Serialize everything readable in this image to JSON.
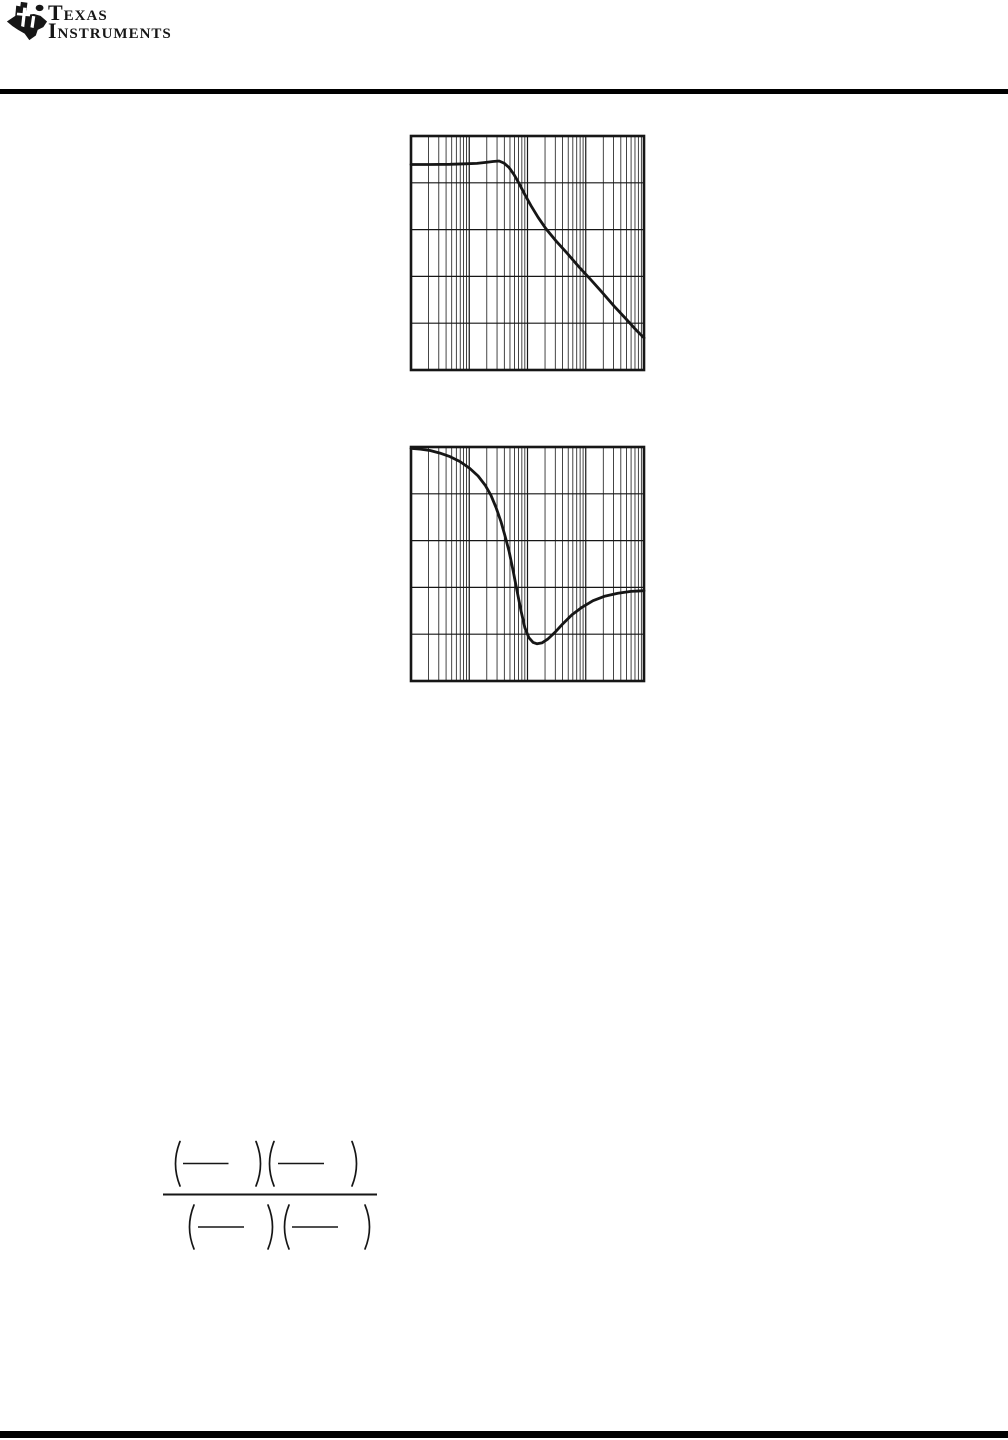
{
  "page": {
    "background": "#ffffff",
    "ink_color": "#161616",
    "note": "Datasheet page render in which all body text glyphs failed to render; only vector graphics (logo, chart grids, curves, formula fence/bars, rules) are visible."
  },
  "header": {
    "logo": {
      "icon": "ti-texas-bug-icon",
      "brand_line1": "Texas",
      "brand_line2": "Instruments"
    },
    "rule_color": "#000000"
  },
  "chart_data": [
    {
      "id": "magnitude-response",
      "type": "line",
      "title": "",
      "xlabel": "",
      "ylabel": "",
      "axis_tick_labels_rendered": false,
      "x_scale": "log",
      "x_decades": 4,
      "x_minor_divisions": [
        2,
        3,
        4,
        5,
        6,
        7,
        8,
        9
      ],
      "y_divisions": 5,
      "grid": true,
      "line_color": "#161616",
      "frame_px": {
        "left": 411,
        "top": 136,
        "width": 233,
        "height": 234
      },
      "description": "Gain-style curve: flat at ~0.12 of plot height for first ~1.5 decades, tiny peak near 0.38 of width, then steady log-linear roll-off exiting right edge at ~0.86 of height.",
      "points_frac": [
        [
          0.0,
          0.122
        ],
        [
          0.082,
          0.122
        ],
        [
          0.167,
          0.121
        ],
        [
          0.232,
          0.119
        ],
        [
          0.283,
          0.117
        ],
        [
          0.322,
          0.113
        ],
        [
          0.352,
          0.109
        ],
        [
          0.378,
          0.107
        ],
        [
          0.399,
          0.116
        ],
        [
          0.421,
          0.135
        ],
        [
          0.442,
          0.165
        ],
        [
          0.464,
          0.203
        ],
        [
          0.489,
          0.251
        ],
        [
          0.515,
          0.298
        ],
        [
          0.545,
          0.347
        ],
        [
          0.579,
          0.396
        ],
        [
          0.622,
          0.448
        ],
        [
          0.67,
          0.501
        ],
        [
          0.717,
          0.555
        ],
        [
          0.768,
          0.61
        ],
        [
          0.82,
          0.668
        ],
        [
          0.871,
          0.726
        ],
        [
          0.923,
          0.782
        ],
        [
          0.966,
          0.829
        ],
        [
          1.0,
          0.863
        ]
      ]
    },
    {
      "id": "phase-response",
      "type": "line",
      "title": "",
      "xlabel": "",
      "ylabel": "",
      "axis_tick_labels_rendered": false,
      "x_scale": "log",
      "x_decades": 4,
      "x_minor_divisions": [
        2,
        3,
        4,
        5,
        6,
        7,
        8,
        9
      ],
      "y_divisions": 5,
      "grid": true,
      "line_color": "#161616",
      "frame_px": {
        "left": 411,
        "top": 447,
        "width": 233,
        "height": 234
      },
      "description": "Phase-style curve: starts on the top border, rolls down with a steep fall near mid-plot, reaches minimum ~0.84 of height at ~0.54 of width, then recovers and flattens at ~0.61 of height at the right edge.",
      "points_frac": [
        [
          0.0,
          0.006
        ],
        [
          0.039,
          0.009
        ],
        [
          0.082,
          0.015
        ],
        [
          0.124,
          0.026
        ],
        [
          0.167,
          0.041
        ],
        [
          0.21,
          0.062
        ],
        [
          0.253,
          0.092
        ],
        [
          0.288,
          0.124
        ],
        [
          0.318,
          0.163
        ],
        [
          0.343,
          0.206
        ],
        [
          0.365,
          0.258
        ],
        [
          0.386,
          0.318
        ],
        [
          0.403,
          0.378
        ],
        [
          0.421,
          0.446
        ],
        [
          0.438,
          0.528
        ],
        [
          0.455,
          0.614
        ],
        [
          0.472,
          0.7
        ],
        [
          0.489,
          0.773
        ],
        [
          0.506,
          0.815
        ],
        [
          0.524,
          0.835
        ],
        [
          0.541,
          0.841
        ],
        [
          0.562,
          0.837
        ],
        [
          0.588,
          0.82
        ],
        [
          0.618,
          0.792
        ],
        [
          0.652,
          0.755
        ],
        [
          0.691,
          0.717
        ],
        [
          0.734,
          0.685
        ],
        [
          0.781,
          0.657
        ],
        [
          0.833,
          0.637
        ],
        [
          0.888,
          0.625
        ],
        [
          0.944,
          0.617
        ],
        [
          1.0,
          0.614
        ]
      ]
    }
  ],
  "formula": {
    "description": "Transfer-function fraction skeleton: (—)(—) over (—)(—); inner text glyphs not rendered in source page.",
    "ink": "#161616",
    "viewbox": {
      "x": 155,
      "y": 1128,
      "width": 240,
      "height": 135
    },
    "main_bar": {
      "x1": 163,
      "x2": 377,
      "y": 1194.5
    },
    "rows": [
      {
        "paren_top": 1141.5,
        "paren_bottom": 1186,
        "parens": [
          {
            "x": 180,
            "dir": "open"
          },
          {
            "x": 256,
            "dir": "close"
          },
          {
            "x": 274,
            "dir": "open"
          },
          {
            "x": 352,
            "dir": "close"
          }
        ],
        "bars": [
          {
            "x1": 183,
            "x2": 228.5,
            "y": 1163.5
          },
          {
            "x1": 278,
            "x2": 324,
            "y": 1163.5
          }
        ]
      },
      {
        "paren_top": 1205,
        "paren_bottom": 1249,
        "parens": [
          {
            "x": 194,
            "dir": "open"
          },
          {
            "x": 268,
            "dir": "close"
          },
          {
            "x": 289,
            "dir": "open"
          },
          {
            "x": 365,
            "dir": "close"
          }
        ],
        "bars": [
          {
            "x1": 198,
            "x2": 244,
            "y": 1227
          },
          {
            "x1": 292,
            "x2": 338,
            "y": 1227
          }
        ]
      }
    ]
  },
  "footer": {
    "bar_color": "#000000"
  }
}
